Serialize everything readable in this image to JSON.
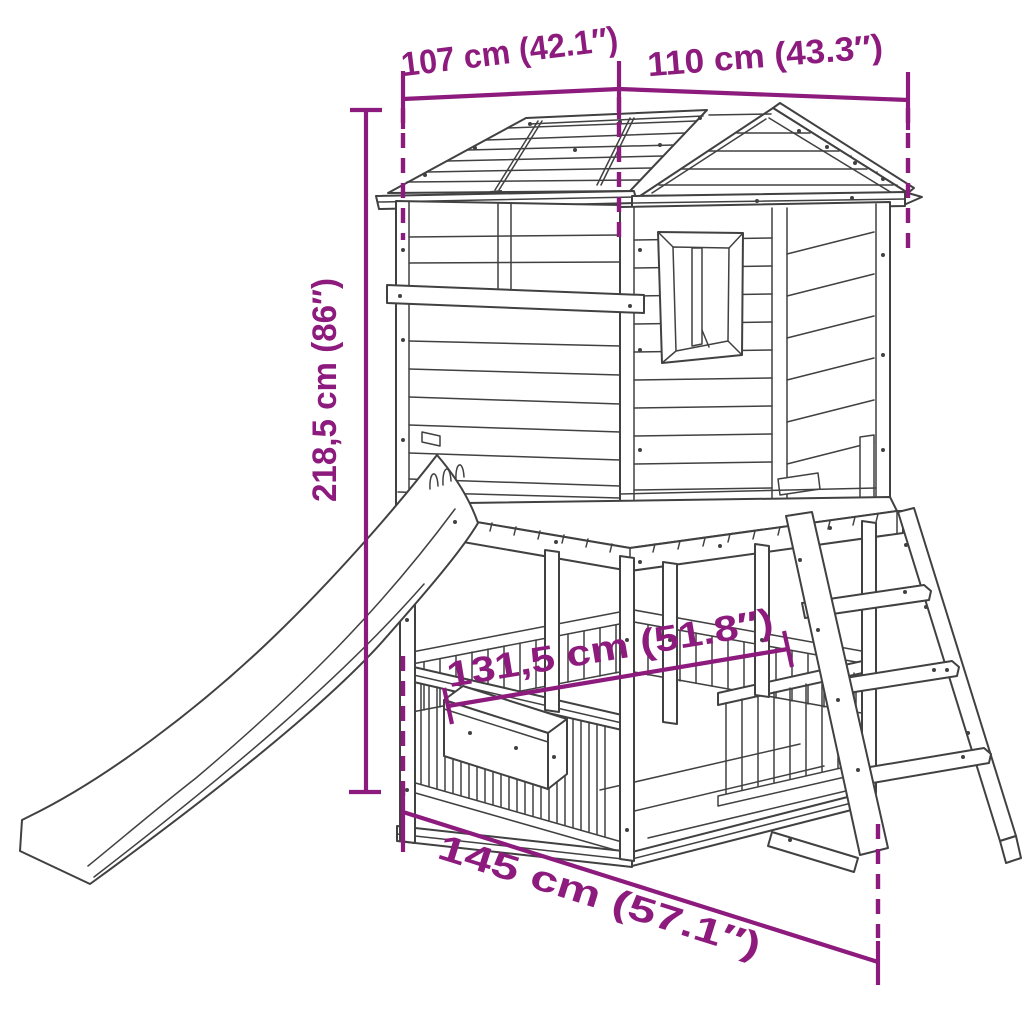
{
  "diagram": {
    "kind": "product-dimension-line-drawing",
    "subject": "playhouse-with-slide-and-ladder",
    "colors": {
      "dimension_annotation": "#8D1B7D",
      "line_art": "#414141",
      "background": "#FFFFFF"
    },
    "dimensions": {
      "roof_left": {
        "label": "107 cm (42.1″)"
      },
      "roof_right": {
        "label": "110 cm (43.3″)"
      },
      "height": {
        "label": "218,5 cm (86″)"
      },
      "deck_width": {
        "label": "131,5 cm (51.8″)"
      },
      "base_width": {
        "label": "145 cm (57.1″)"
      }
    }
  }
}
